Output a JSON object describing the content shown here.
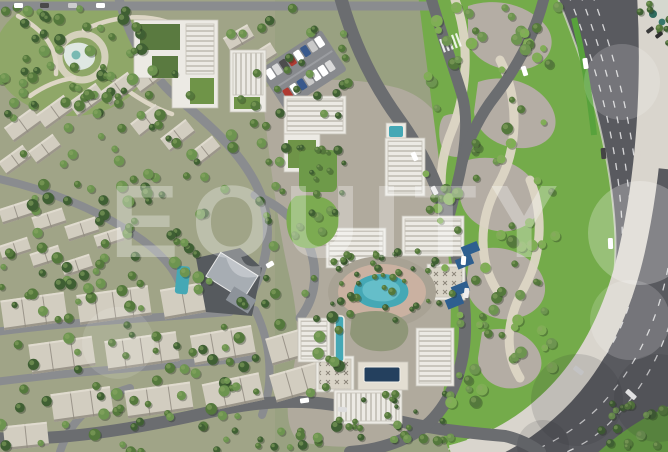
{
  "scene": {
    "kind": "aerial-masterplan-render",
    "description": "Top-down render of a residential masterplan: villa district left, apartment blocks with amenity pools center, landscaped dune park and curved multi-lane highway right",
    "watermark": {
      "text": "EQUITY",
      "opacity": 0.3
    }
  },
  "palette": {
    "watermark_color": "#ffffff",
    "ground": "#99a181",
    "villa_ground": "#a0a487",
    "park_grass": "#8fa768",
    "plaza": "#b0aa9d",
    "grass": "#74ab4a",
    "verge_green": "#5f9140",
    "stone_patch": "#b4ada4",
    "gravel_path": "#ddd6c5",
    "asphalt": "#595a5f",
    "road": "#6b6d70",
    "street": "#8a8c8f",
    "concrete_band": "#d9d5cd",
    "median_green": "#58a23c",
    "roof_light": "#d2cdc0",
    "roof_ridge": "#9b958a",
    "roof_shadow": "#8d887c",
    "building_white": "#eceae4",
    "roof_stripe": "#c9c6bd",
    "green_roof": "#5a7a40",
    "lawn": "#7cab51",
    "pool_turquoise": "#45a8b5",
    "pool_navy": "#24405e",
    "canopy_blue": "#2e5f8f",
    "tree_dark": "#3f5f33",
    "tree_mid": "#54783c",
    "tree_light": "#6d9450",
    "clubhouse_dark": "#565a5e",
    "deck_pink": "#cdb3a2",
    "lane_marking": "#ffffff"
  }
}
